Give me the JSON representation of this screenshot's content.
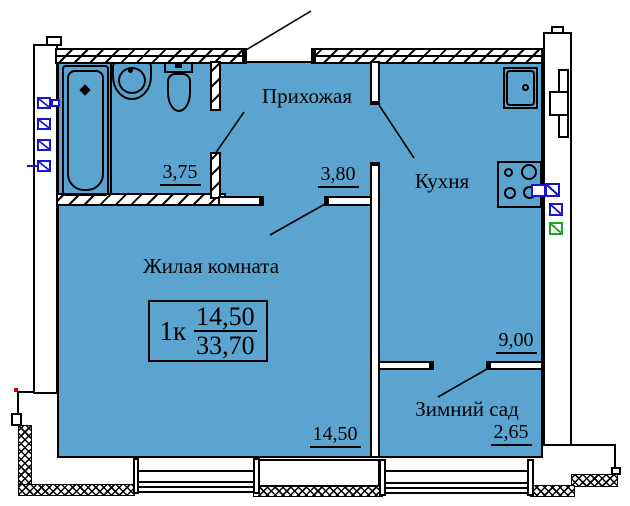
{
  "floor_plan": {
    "unit_box": {
      "unit": "1к",
      "living_area": "14,50",
      "total_area": "33,70"
    },
    "rooms": {
      "hallway": {
        "label": "Прихожая",
        "area": "3,80"
      },
      "kitchen": {
        "label": "Кухня",
        "area": "9,00"
      },
      "living_room": {
        "label": "Жилая комната",
        "area": "14,50"
      },
      "winter_garden": {
        "label": "Зимний сад",
        "area": "2,65"
      },
      "bathroom": {
        "area": "3,75"
      }
    },
    "colors": {
      "room_fill": "#5BA4CF",
      "marker_blue": "#1A16D0",
      "marker_green": "#1FA32A",
      "red_dot": "#D40000"
    },
    "fixtures": [
      "bathtub-icon",
      "bath-sink-icon",
      "toilet-icon",
      "kitchen-sink-icon",
      "stove-icon"
    ]
  }
}
